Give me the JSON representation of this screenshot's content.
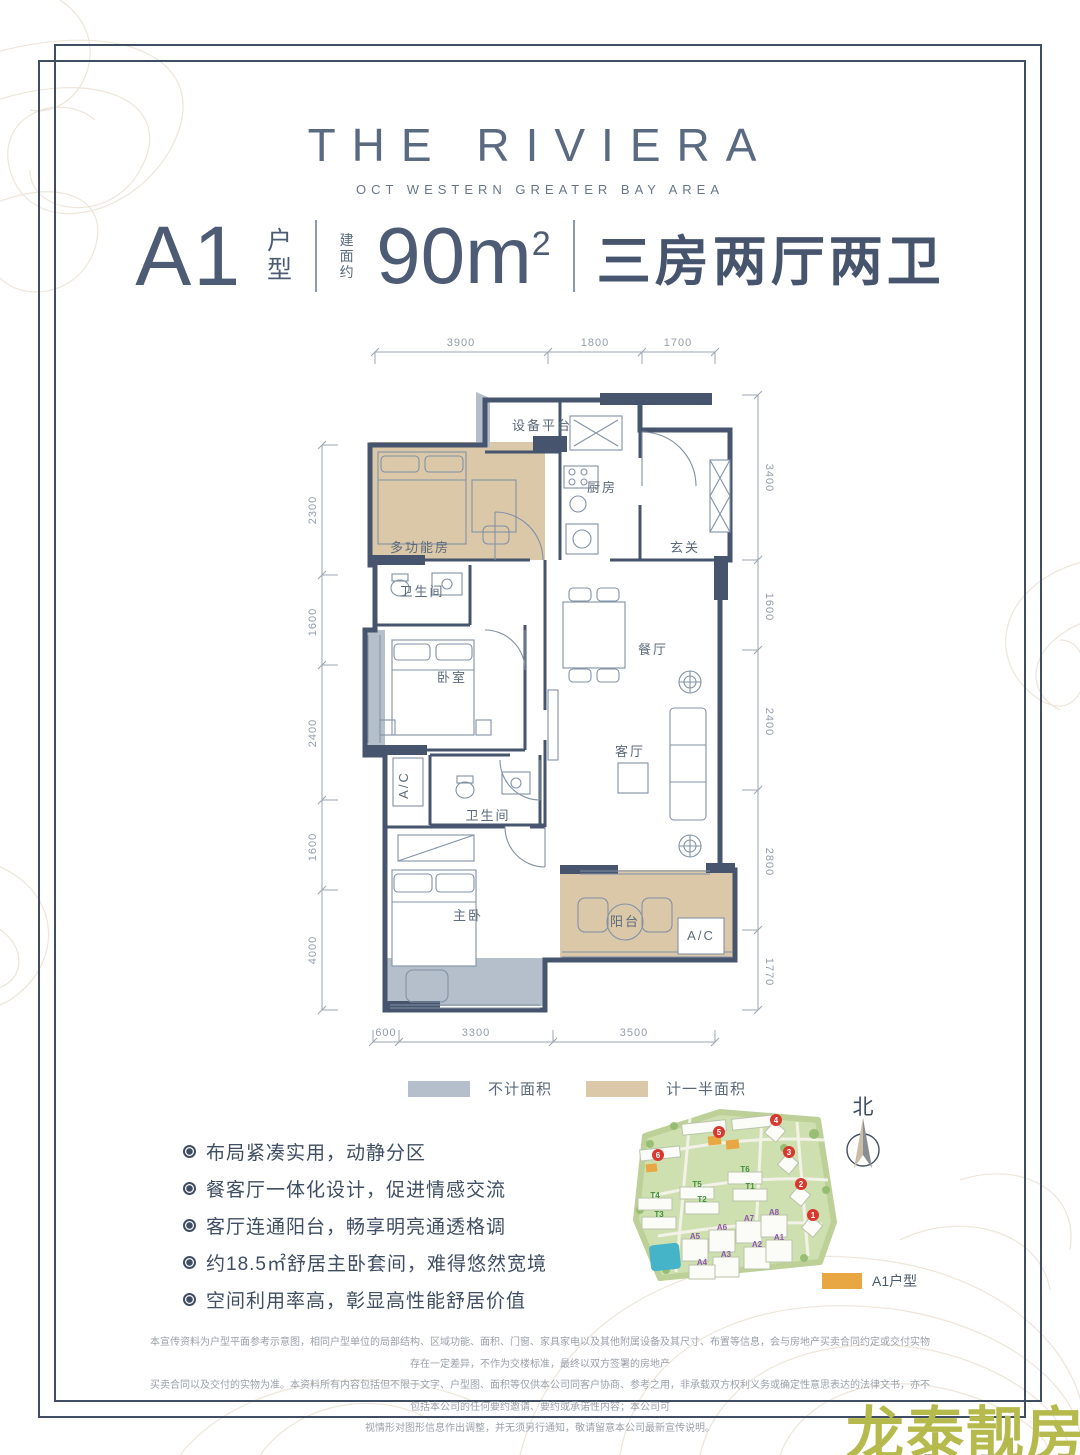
{
  "brand": {
    "title": "THE RIVIERA",
    "subtitle": "OCT WESTERN GREATER BAY AREA"
  },
  "spec": {
    "unit": "A1",
    "unit_type": "户型",
    "area_label": "建面约",
    "area_value": "90m",
    "area_sup": "2",
    "layout": "三房两厅两卫"
  },
  "plan": {
    "dims": {
      "top": [
        "3900",
        "1800",
        "1700"
      ],
      "left": [
        "2300",
        "1600",
        "2400",
        "1600",
        "4000"
      ],
      "right": [
        "3400",
        "1600",
        "2400",
        "2800",
        "1770"
      ],
      "bottom": [
        "600",
        "3300",
        "3500"
      ]
    },
    "rooms": {
      "equip_platform": "设备平台",
      "kitchen": "厨房",
      "entry": "玄关",
      "multi_room": "多功能房",
      "bath1": "卫生间",
      "bedroom": "卧室",
      "dining": "餐厅",
      "living": "客厅",
      "bath2": "卫生间",
      "master": "主卧",
      "balcony": "阳台",
      "ac_left": "A/C",
      "ac_right": "A/C"
    },
    "legend": {
      "gray": "不计面积",
      "tan": "计一半面积"
    }
  },
  "features": [
    "布局紧凑实用，动静分区",
    "餐客厅一体化设计，促进情感交流",
    "客厅连通阳台，畅享明亮通透格调",
    "约18.5㎡舒居主卧套间，难得悠然宽境",
    "空间利用率高，彰显高性能舒居价值"
  ],
  "sitemap": {
    "north": "北",
    "legend": "A1户型",
    "blocks_red": [
      "6",
      "5",
      "4",
      "3",
      "2",
      "1"
    ],
    "blocks_purple": [
      "A5",
      "A6",
      "A7",
      "A8",
      "A2",
      "A1",
      "A3",
      "A4"
    ],
    "blocks_green": [
      "T6",
      "T5",
      "T4",
      "T1",
      "T2",
      "T3"
    ]
  },
  "footer": {
    "line1": "本宣传资料为户型平面参考示意图，相同户型单位的局部结构、区域功能、面积、门窗、家具家电以及其他附属设备及其尺寸、布置等信息，会与房地产买卖合同约定或交付实物存在一定差异，不作为交楼标准，最终以双方签署的房地产",
    "line2": "买卖合同以及交付的实物为准。本资料所有内容包括但不限于文字、户型图、面积等仅供本公司同客户协商、参考之用，非承载双方权利义务或确定性意思表达的法律文书，亦不包括本公司的任何要约邀请、要约或承诺性内容；本公司可",
    "line3": "视情形对图形信息作出调整，并无须另行通知，敬请留意本公司最新宣传说明。"
  },
  "watermark": "龙泰靓房",
  "colors": {
    "wall": "#46556d",
    "tan": "#dbc8a9",
    "gray": "#b5bfcb",
    "accent_orange": "#e8a742",
    "watermark": "#b6ba4d"
  }
}
